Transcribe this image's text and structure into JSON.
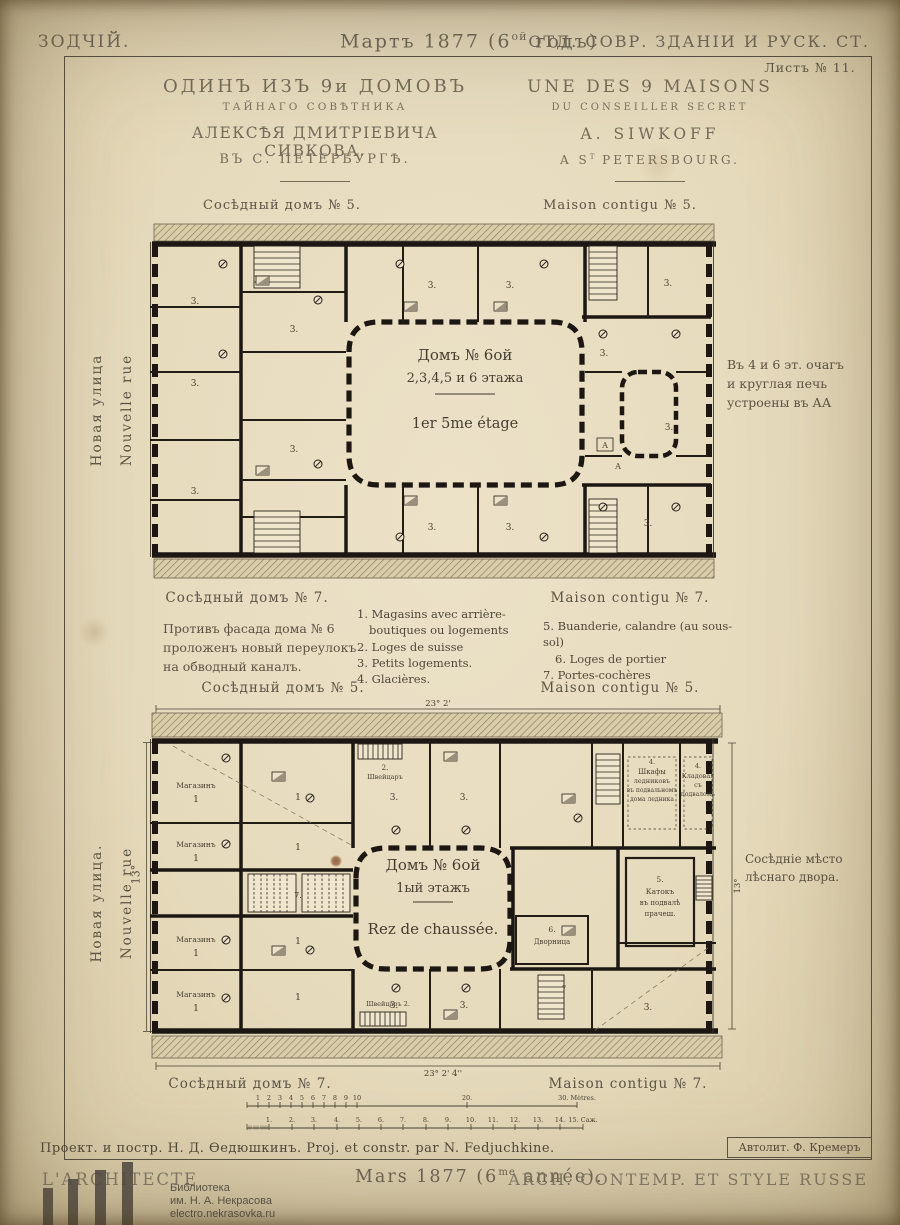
{
  "masthead": {
    "left": "ЗОДЧІЙ.",
    "center_pre": "Мартъ 1877 (6",
    "center_sup": "ой",
    "center_post": " годъ)",
    "right": "ОТД. СОВР. ЗДАНІИ И РУСК. СТ.",
    "sheet": "Листъ № 11."
  },
  "title_block": {
    "ru": [
      "ОДИНЪ ИЗЪ 9и ДОМОВЪ",
      "ТАЙНАГО СОВѢТНИКА",
      "АЛЕКСѢЯ ДМИТРІЕВИЧА СИВКОВА.",
      "ВЪ С. ПЕТЕРБУРГѢ."
    ],
    "fr_line1": "UNE DES 9 MAISONS",
    "fr_line2": "DU CONSEILLER SECRET",
    "fr_line3": "A. SIWKOFF",
    "fr_line4_pre": "A S",
    "fr_line4_sup": "T",
    "fr_line4_post": " PETERSBOURG."
  },
  "upper_plan": {
    "neighbor_top_ru": "Сосѣдный домъ № 5.",
    "neighbor_top_fr": "Maison contigu № 5.",
    "neighbor_bottom_ru": "Сосѣдный домъ № 7.",
    "neighbor_bottom_fr": "Maison contigu № 7.",
    "street_ru": "Новая улица",
    "street_fr": "Nouvelle rue",
    "note_right": [
      "Въ 4 и 6 эт. очагъ",
      "и круглая печь",
      "устроены въ АА"
    ],
    "labels": [
      {
        "t": "Домъ № 6ой",
        "x": 317,
        "y": 138,
        "s": 15,
        "n": "plan-title"
      },
      {
        "t": "2,3,4,5 и 6 этажа",
        "x": 317,
        "y": 160,
        "s": 13,
        "n": "plan-title"
      },
      {
        "t": "1er 5me étage",
        "x": 317,
        "y": 206,
        "s": 14.5,
        "n": "plan-title"
      },
      {
        "t": "3.",
        "x": 47,
        "y": 82,
        "s": 9
      },
      {
        "t": "3.",
        "x": 47,
        "y": 164,
        "s": 9
      },
      {
        "t": "3.",
        "x": 47,
        "y": 272,
        "s": 9
      },
      {
        "t": "3.",
        "x": 146,
        "y": 110,
        "s": 9
      },
      {
        "t": "3.",
        "x": 146,
        "y": 230,
        "s": 9
      },
      {
        "t": "3.",
        "x": 284,
        "y": 66,
        "s": 9
      },
      {
        "t": "3.",
        "x": 362,
        "y": 66,
        "s": 9
      },
      {
        "t": "3.",
        "x": 284,
        "y": 308,
        "s": 9
      },
      {
        "t": "3.",
        "x": 362,
        "y": 308,
        "s": 9
      },
      {
        "t": "3.",
        "x": 520,
        "y": 64,
        "s": 9
      },
      {
        "t": "3.",
        "x": 456,
        "y": 134,
        "s": 9
      },
      {
        "t": "3.",
        "x": 521,
        "y": 208,
        "s": 9
      },
      {
        "t": "3.",
        "x": 500,
        "y": 304,
        "s": 9
      },
      {
        "t": "А",
        "x": 457,
        "y": 226,
        "s": 8
      },
      {
        "t": "А",
        "x": 470,
        "y": 247,
        "s": 8
      }
    ]
  },
  "legend": {
    "note_ru": [
      "Противъ фасада дома № 6",
      "проложенъ новый переулокъ",
      "на обводный каналъ."
    ],
    "col1": [
      "1. Magasins avec arrière-",
      "boutiques ou logements",
      "2. Loges de suisse",
      "3. Petits logements.",
      "4. Glacières."
    ],
    "col2": [
      "5. Buanderie, calandre (au sous-sol)",
      "6. Loges de portier",
      "7. Portes-cochères"
    ]
  },
  "lower_plan": {
    "neighbor_top_ru": "Сосѣдный домъ № 5.",
    "neighbor_top_fr": "Maison contigu № 5.",
    "neighbor_bottom_ru": "Сосѣдный домъ № 7.",
    "neighbor_bottom_fr": "Maison contigu № 7.",
    "street_ru": "Новая улица.",
    "street_fr": "Nouvelle rue",
    "dim_left": "13°",
    "note_right": [
      "Сосѣдніе мѣсто",
      "лѣснаго двора."
    ],
    "labels": [
      {
        "t": "Домъ № 6ой",
        "x": 285,
        "y": 172,
        "s": 15,
        "n": "plan-title"
      },
      {
        "t": "1ый этажъ",
        "x": 285,
        "y": 194,
        "s": 13,
        "n": "plan-title"
      },
      {
        "t": "Rez de chaussée.",
        "x": 285,
        "y": 236,
        "s": 15,
        "n": "plan-title"
      },
      {
        "t": "23° 2'",
        "x": 290,
        "y": 8,
        "s": 8.5,
        "n": "dim-label"
      },
      {
        "t": "23° 2' 4''",
        "x": 295,
        "y": 378,
        "s": 8.5,
        "n": "dim-label"
      },
      {
        "t": "13°",
        "x": 592,
        "y": 188,
        "s": 8.5,
        "r": -90,
        "n": "dim-label"
      },
      {
        "t": "Магазинъ",
        "x": 48,
        "y": 90,
        "s": 7.5
      },
      {
        "t": "1",
        "x": 48,
        "y": 104,
        "s": 9.5
      },
      {
        "t": "Магазинъ",
        "x": 48,
        "y": 149,
        "s": 7.5
      },
      {
        "t": "1",
        "x": 48,
        "y": 163,
        "s": 9.5
      },
      {
        "t": "Магазинъ",
        "x": 48,
        "y": 244,
        "s": 7.5
      },
      {
        "t": "1",
        "x": 48,
        "y": 258,
        "s": 9.5
      },
      {
        "t": "Магазинъ",
        "x": 48,
        "y": 299,
        "s": 7.5
      },
      {
        "t": "1",
        "x": 48,
        "y": 313,
        "s": 9.5
      },
      {
        "t": "1",
        "x": 150,
        "y": 102,
        "s": 9.5
      },
      {
        "t": "1",
        "x": 150,
        "y": 152,
        "s": 9.5
      },
      {
        "t": "1",
        "x": 150,
        "y": 246,
        "s": 9.5
      },
      {
        "t": "1",
        "x": 150,
        "y": 302,
        "s": 9.5
      },
      {
        "t": "7.",
        "x": 150,
        "y": 200,
        "s": 8
      },
      {
        "t": "7",
        "x": 416,
        "y": 293,
        "s": 7
      },
      {
        "t": "3.",
        "x": 246,
        "y": 102,
        "s": 9
      },
      {
        "t": "3.",
        "x": 316,
        "y": 102,
        "s": 9
      },
      {
        "t": "3.",
        "x": 246,
        "y": 310,
        "s": 9
      },
      {
        "t": "3.",
        "x": 316,
        "y": 310,
        "s": 9
      },
      {
        "t": "3.",
        "x": 500,
        "y": 312,
        "s": 9
      },
      {
        "t": "2.",
        "x": 237,
        "y": 72,
        "s": 7
      },
      {
        "t": "Швейцаръ",
        "x": 237,
        "y": 81,
        "s": 6.5
      },
      {
        "t": "Швейцаръ 2.",
        "x": 240,
        "y": 308,
        "s": 6.5
      },
      {
        "t": "4.",
        "x": 504,
        "y": 66,
        "s": 6.5
      },
      {
        "t": "Шкафы",
        "x": 504,
        "y": 76,
        "s": 7
      },
      {
        "t": "ледниковъ",
        "x": 504,
        "y": 85,
        "s": 6.5
      },
      {
        "t": "въ подвальномъ",
        "x": 504,
        "y": 94,
        "s": 6
      },
      {
        "t": "дома ледника",
        "x": 504,
        "y": 103,
        "s": 6
      },
      {
        "t": "4.",
        "x": 550,
        "y": 70,
        "s": 6.5
      },
      {
        "t": "Кладовая",
        "x": 550,
        "y": 80,
        "s": 6.5
      },
      {
        "t": "съ",
        "x": 550,
        "y": 89,
        "s": 6.5
      },
      {
        "t": "подваломъ",
        "x": 550,
        "y": 98,
        "s": 6
      },
      {
        "t": "5.",
        "x": 512,
        "y": 184,
        "s": 7.5
      },
      {
        "t": "Катокъ",
        "x": 512,
        "y": 196,
        "s": 7.5
      },
      {
        "t": "въ подвалѣ",
        "x": 512,
        "y": 207,
        "s": 7
      },
      {
        "t": "прачеш.",
        "x": 512,
        "y": 218,
        "s": 7
      },
      {
        "t": "6.",
        "x": 404,
        "y": 234,
        "s": 7.5
      },
      {
        "t": "Дворница",
        "x": 404,
        "y": 246,
        "s": 7
      }
    ]
  },
  "scalebar": {
    "metres": {
      "y": 14,
      "x1": 14,
      "x2": 344,
      "ticks": [
        {
          "t": "",
          "x": 14
        },
        {
          "t": "1",
          "x": 25
        },
        {
          "t": "2",
          "x": 36
        },
        {
          "t": "3",
          "x": 47
        },
        {
          "t": "4",
          "x": 58
        },
        {
          "t": "5",
          "x": 69
        },
        {
          "t": "6",
          "x": 80
        },
        {
          "t": "7",
          "x": 91
        },
        {
          "t": "8",
          "x": 102
        },
        {
          "t": "9",
          "x": 113
        },
        {
          "t": "10",
          "x": 124
        },
        {
          "t": "20.",
          "x": 234
        },
        {
          "t": "30. Mètres.",
          "x": 344
        }
      ],
      "minor": []
    },
    "sazhen": {
      "y": 36,
      "x1": 14,
      "x2": 350,
      "ticks": [
        {
          "t": "",
          "x": 14
        },
        {
          "t": "1.",
          "x": 36
        },
        {
          "t": "2.",
          "x": 59
        },
        {
          "t": "3.",
          "x": 81
        },
        {
          "t": "4.",
          "x": 104
        },
        {
          "t": "5.",
          "x": 126
        },
        {
          "t": "6.",
          "x": 148
        },
        {
          "t": "7.",
          "x": 170
        },
        {
          "t": "8.",
          "x": 193
        },
        {
          "t": "9.",
          "x": 215
        },
        {
          "t": "10.",
          "x": 238
        },
        {
          "t": "11.",
          "x": 260
        },
        {
          "t": "12.",
          "x": 282
        },
        {
          "t": "13.",
          "x": 305
        },
        {
          "t": "14.",
          "x": 327
        },
        {
          "t": "15. Саж.",
          "x": 350
        }
      ],
      "minor": [
        16,
        18,
        21,
        23,
        25,
        28,
        30,
        32,
        34
      ]
    }
  },
  "credit": {
    "line": "Проект. и постр. Н. Д. Ѳедюшкинъ. Proj. et constr. par N. Fedjuchkine.",
    "lith": "Автолит. Ф. Кремеръ"
  },
  "footer": {
    "left": "L'ARCHITECTE",
    "center_pre": "Mars 1877 (6",
    "center_sup": "me",
    "center_post": " année).",
    "right": "ARCH. CONTEMP. ET STYLE RUSSE"
  },
  "watermark": {
    "lines": [
      "Библиотека",
      "им. Н. А. Некрасова",
      "electro.nekrasovka.ru"
    ]
  }
}
